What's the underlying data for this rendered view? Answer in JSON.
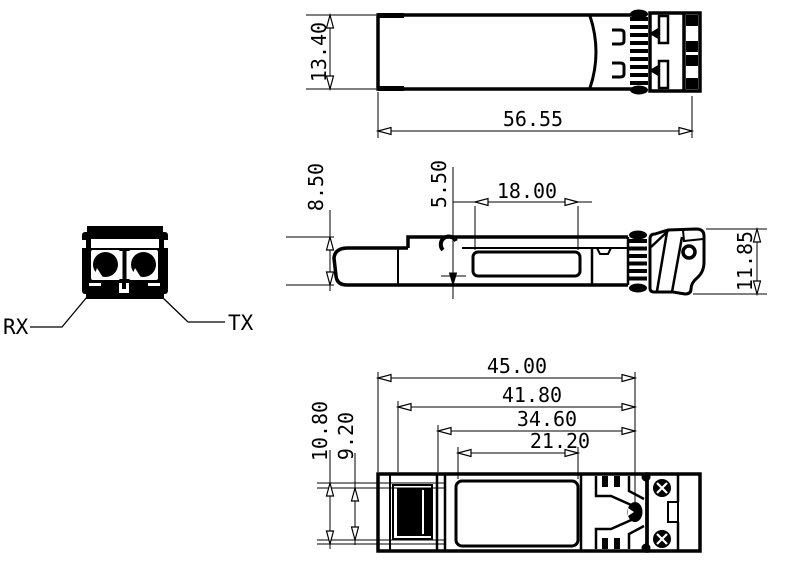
{
  "labels": {
    "front_view": {
      "rx": "RX",
      "tx": "TX"
    },
    "top_view": {
      "width": "13.40",
      "length": "56.55"
    },
    "side_view": {
      "body_height": "8.50",
      "offset": "5.50",
      "label_pocket_length": "18.00",
      "overall_height": "11.85"
    },
    "bottom_view": {
      "length_1": "45.00",
      "length_2": "41.80",
      "length_3": "34.60",
      "length_4": "21.20",
      "width_1": "10.80",
      "width_2": "9.20"
    }
  },
  "colors": {
    "line": "#000000",
    "background": "#ffffff"
  }
}
